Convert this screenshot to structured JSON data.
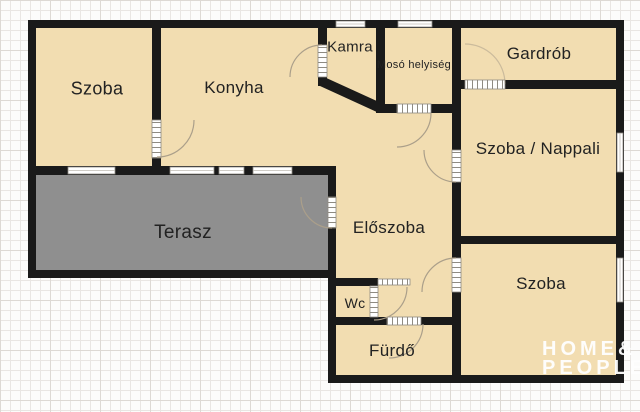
{
  "colors": {
    "background": "#fcfcfb",
    "grid-line": "#e9e6e3",
    "grid-accent": "#ddd9d4",
    "room-fill": "#f2ddb1",
    "terrace-fill": "#8f8f8f",
    "wall": "#1a1a1a",
    "frame": "#8f8b82",
    "door-arc": "#ab9f8a",
    "label": "#222222",
    "watermark": "#ffffff"
  },
  "rooms": [
    {
      "name": "szoba-top-left",
      "label": "Szoba"
    },
    {
      "name": "konyha",
      "label": "Konyha"
    },
    {
      "name": "kamra",
      "label": "Kamra"
    },
    {
      "name": "moso-helyiseg",
      "label": "Mosó helyiség"
    },
    {
      "name": "gardrob",
      "label": "Gardrób"
    },
    {
      "name": "szoba-nappali",
      "label": "Szoba / Nappali"
    },
    {
      "name": "eloszoba",
      "label": "Előszoba"
    },
    {
      "name": "terasz",
      "label": "Terasz"
    },
    {
      "name": "wc",
      "label": "Wc"
    },
    {
      "name": "furdo",
      "label": "Fürdő"
    },
    {
      "name": "szoba-bottom",
      "label": "Szoba"
    }
  ],
  "watermark": {
    "line1": "HOME&",
    "line2": "PEOPLE"
  }
}
